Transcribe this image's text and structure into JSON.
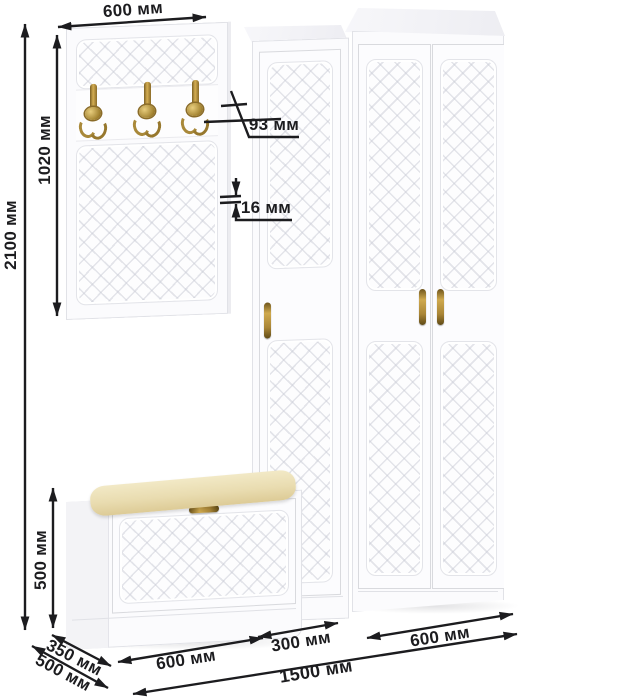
{
  "units": "мм",
  "dimensions": {
    "hook_panel_width": "600 мм",
    "hook_panel_height": "1020 мм",
    "total_height": "2100 мм",
    "hook_projection": "93 мм",
    "panel_thickness": "16 мм",
    "bench_height": "500 мм",
    "bench_depth": "350 мм",
    "wardrobe_depth": "500 мм",
    "bench_width": "600 мм",
    "cabinet_width": "300 мм",
    "wardrobe_width": "600 мм",
    "total_width": "1500 мм"
  },
  "scene": {
    "items": [
      "coat-hook-panel",
      "tall-cabinet",
      "two-door-wardrobe",
      "shoe-bench-with-cushion"
    ],
    "hook_count": 3,
    "wardrobe_door_count": 2
  },
  "colors": {
    "furniture_white": "#fbfbfd",
    "cushion_cream": "#eadfb0",
    "brass": "#b2913e",
    "dimension_ink": "#1c1c1f"
  }
}
